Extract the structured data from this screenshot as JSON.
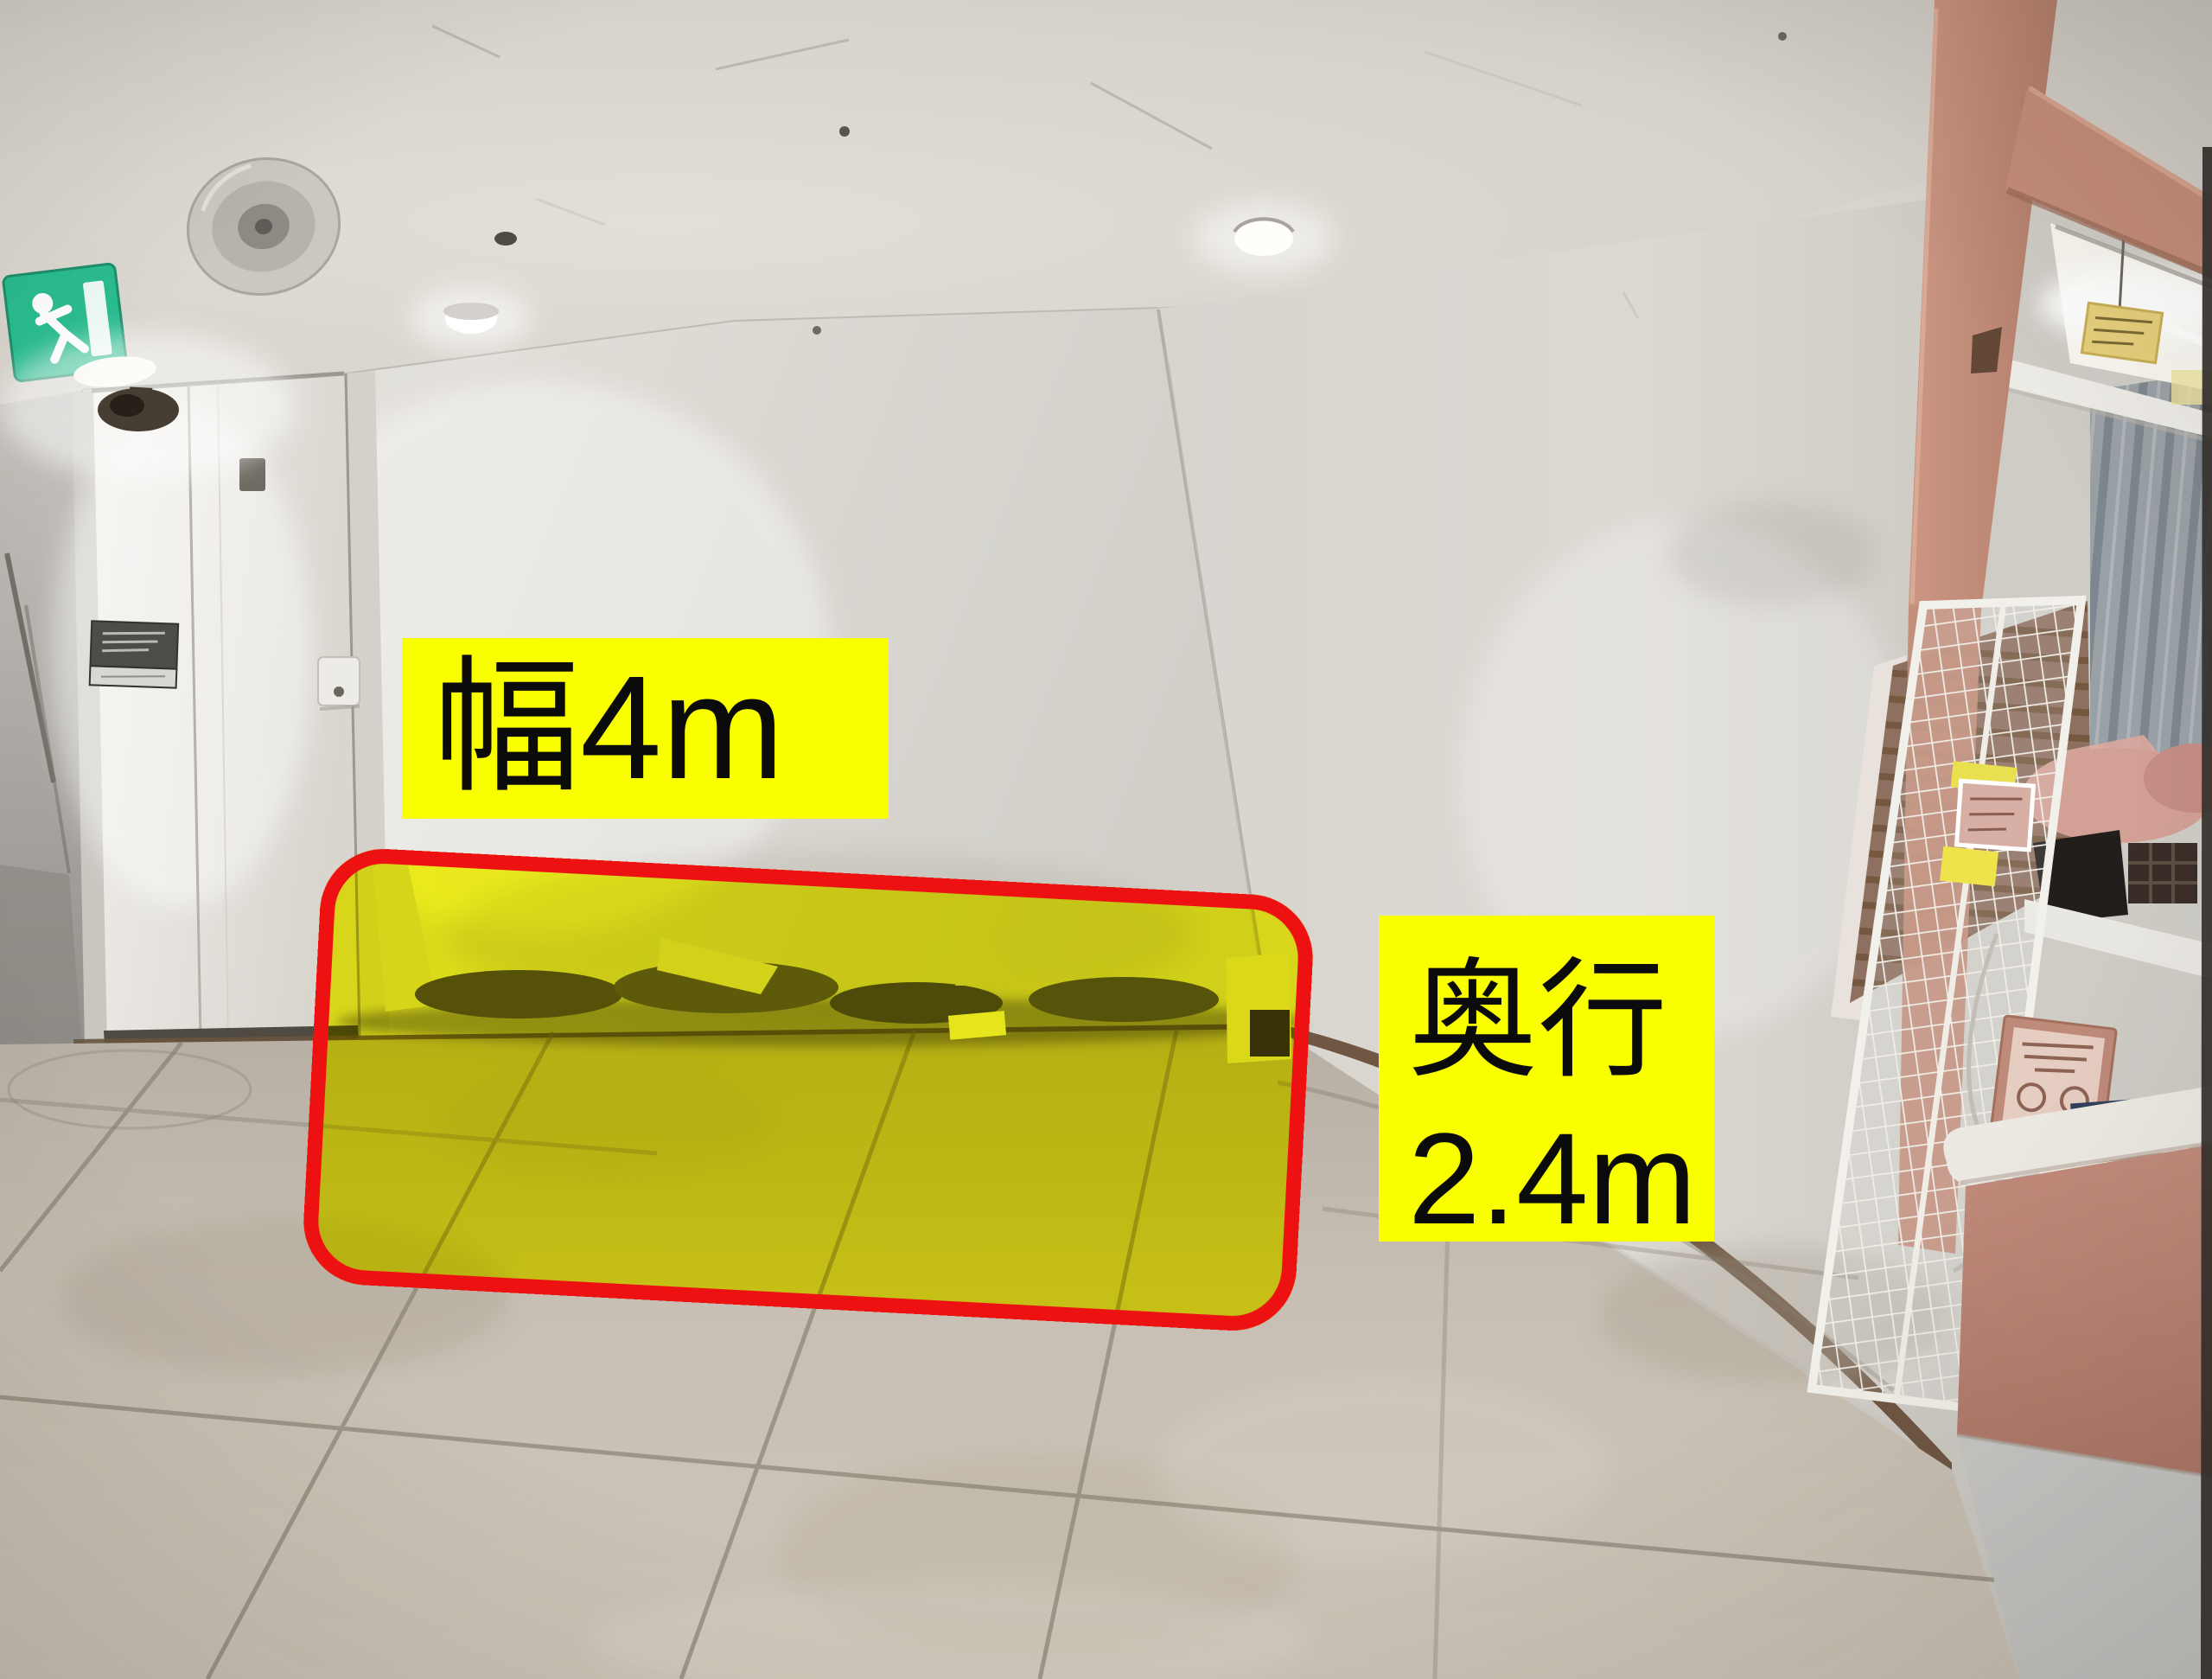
{
  "annotations": {
    "width_label": {
      "text": "幅4m"
    },
    "depth_label": {
      "line1": "奥行",
      "line2": "2.4m"
    },
    "style": {
      "label_background": "#faff00",
      "label_text_color": "#0b0b0b",
      "outline_color": "#ee1111",
      "highlight_fill": "#fdff00"
    }
  },
  "scene": {
    "palette": {
      "exit_sign_green": "#2abd90",
      "ceiling_white": "#d9d5ce",
      "wall_white": "#dedbd5",
      "floor_tile_beige": "#c7bfb3",
      "grout_gray": "#8a8174",
      "baseboard_brown": "#6b563f",
      "kiosk_pink": "#c48d79",
      "counter_pink": "#bf8a7a",
      "curtain_gray": "#99a1a6",
      "photo_edge_dark": "#34302c"
    }
  }
}
